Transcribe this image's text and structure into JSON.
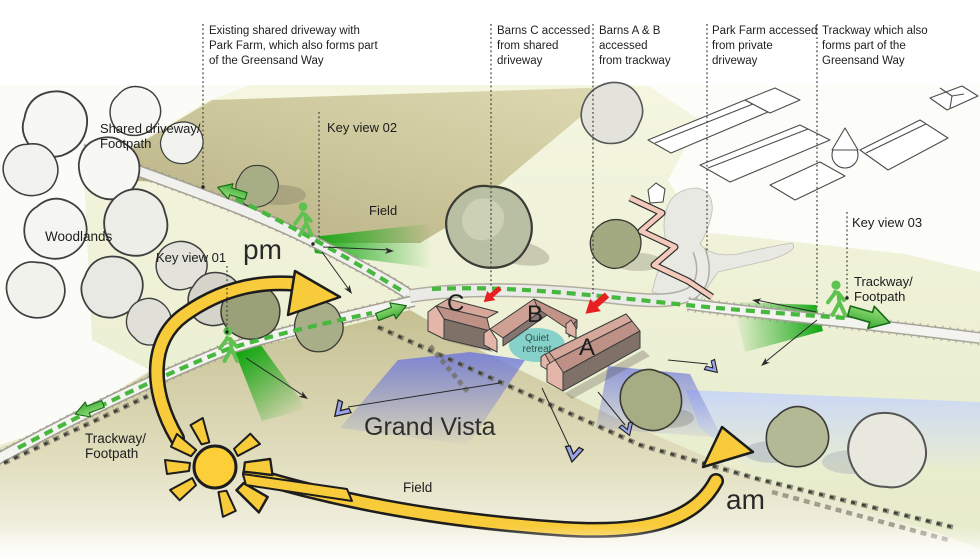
{
  "diagram": {
    "title_hint": "Barn site access and views diagram",
    "annotations": [
      {
        "label": "Existing shared driveway with\nPark Farm, which also forms part\nof the Greensand Way"
      },
      {
        "label": "Barns C accessed\nfrom shared\ndriveway"
      },
      {
        "label": "Barns A & B accessed\nfrom trackway"
      },
      {
        "label": "Park Farm accessed\nfrom private driveway"
      },
      {
        "label": "Trackway which also\nforms part of the\nGreensand Way"
      }
    ],
    "labels": {
      "shared_driveway": "Shared driveway/\nFootpath",
      "key_view_01": "Key view 01",
      "key_view_02": "Key view 02",
      "key_view_03": "Key view 03",
      "woodlands": "Woodlands",
      "field_upper": "Field",
      "field_lower": "Field",
      "trackway_left": "Trackway/\nFootpath",
      "trackway_right": "Trackway/\nFootpath",
      "grand_vista": "Grand Vista",
      "quiet_retreat": "Quiet\nretreat",
      "pm": "pm",
      "am": "am"
    },
    "barns": {
      "a": "A",
      "b": "B",
      "c": "C"
    },
    "colors": {
      "khaki_field": "#c9c399",
      "pale_field": "#eef2d6",
      "path_green": "#46b83e",
      "sun_yellow": "#f8cb3a",
      "vista_blue": "#737cda",
      "retreat_teal": "#82cfca",
      "barn_wall_pink": "#e3b6a9",
      "barn_roof": "#bd9185",
      "alert_red": "#e62020"
    }
  }
}
